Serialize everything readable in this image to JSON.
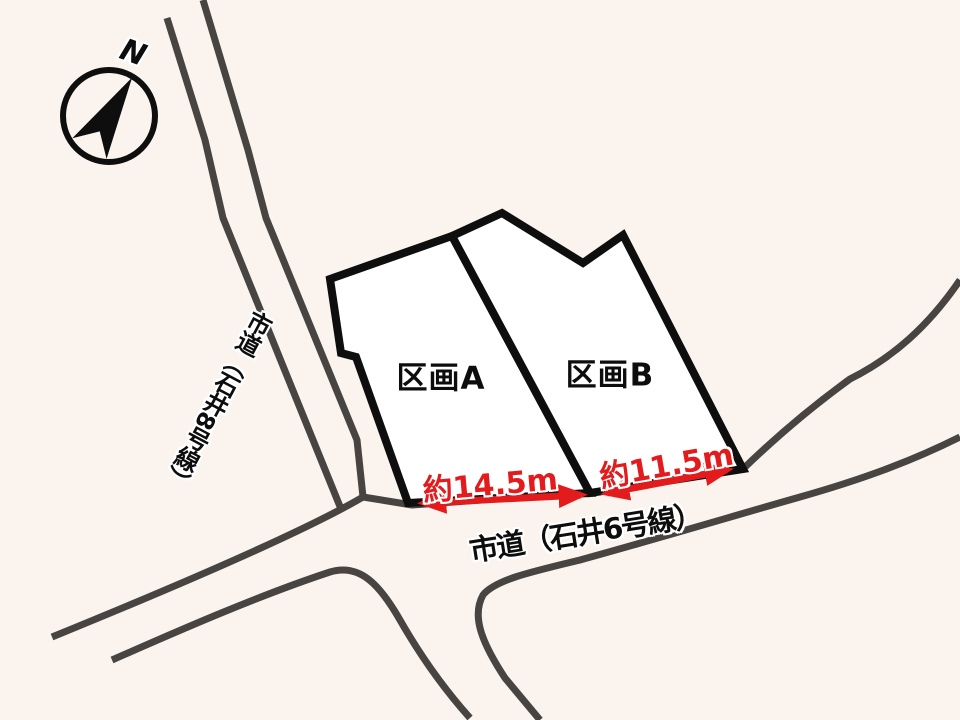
{
  "title": "区画図",
  "colors": {
    "background": "#faf3ee",
    "parcel_fill": "#ffffff",
    "boundary": "#0e0e0e",
    "road": "#474441",
    "dimension": "#e31b1c"
  },
  "compass": {
    "north_label": "N"
  },
  "roads": {
    "ishii8": {
      "label": "市道（石井8号線）"
    },
    "ishii6": {
      "label": "市道（石井6号線）"
    }
  },
  "parcels": {
    "a": {
      "label": "区画A",
      "frontage": "約14.5m"
    },
    "b": {
      "label": "区画B",
      "frontage": "約11.5m"
    }
  }
}
